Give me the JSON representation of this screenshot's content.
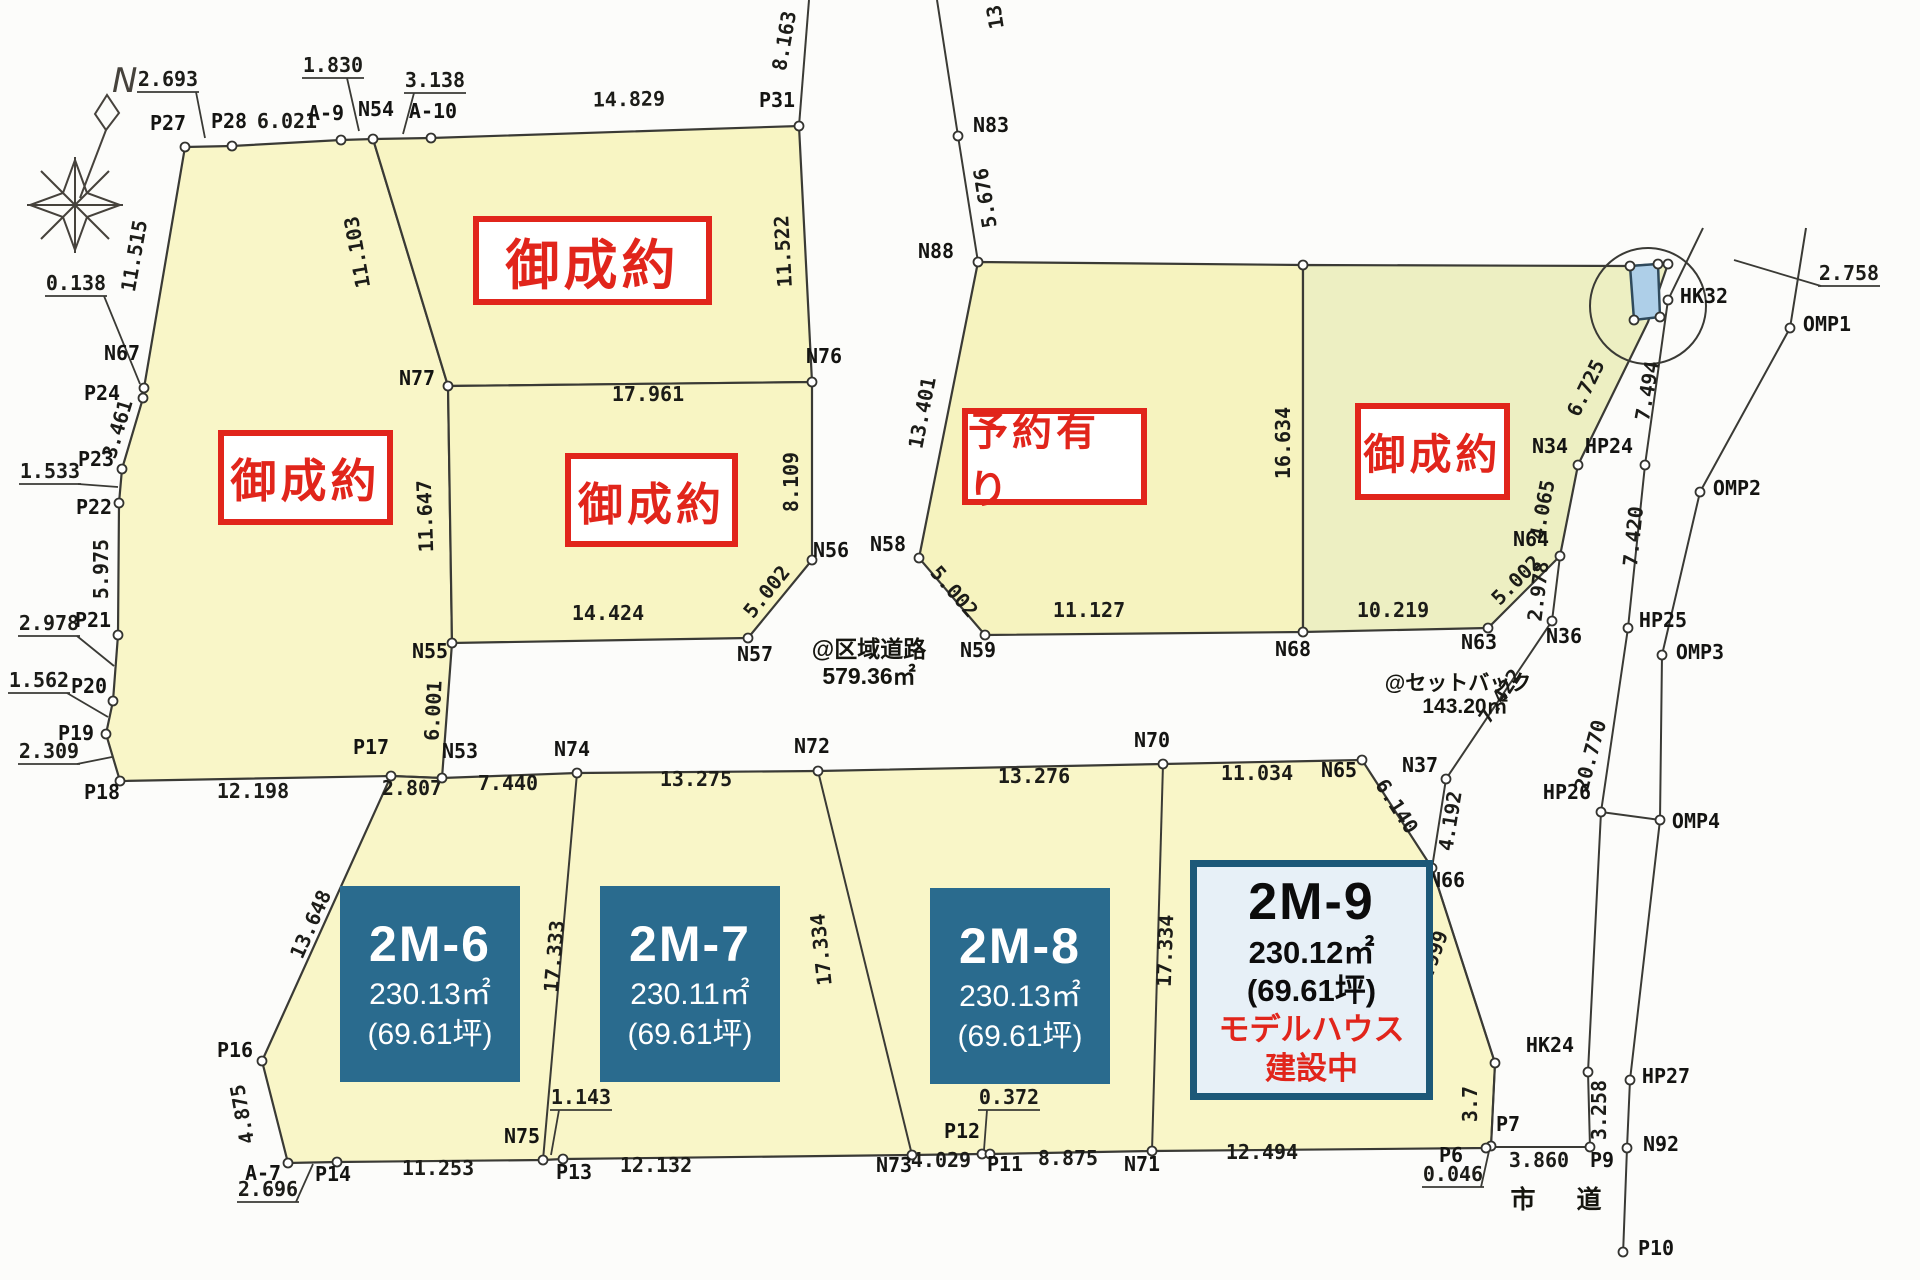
{
  "compass": {
    "label": "N"
  },
  "roads": {
    "district_road": {
      "line1": "@区域道路",
      "line2": "579.36㎡"
    },
    "setback": {
      "line1": "@セットバック",
      "line2": "143.20㎡"
    },
    "city_road": "市　道"
  },
  "colors": {
    "parcel_yellow": "#f9f6c8",
    "parcel_yellow2": "#f6f3bf",
    "parcel_green": "#edefc2",
    "water_blue": "#aecfe8",
    "lot_teal": "#2a6b8e",
    "lot_model_bg": "#e7f0f7",
    "lot_model_border": "#1c5878",
    "status_red": "#e1251b",
    "line": "#3a3a35"
  },
  "status_boxes": [
    {
      "text": "御成約",
      "x": 218,
      "y": 430,
      "w": 175,
      "h": 95,
      "fs": 46
    },
    {
      "text": "御成約",
      "x": 473,
      "y": 216,
      "w": 239,
      "h": 89,
      "fs": 54
    },
    {
      "text": "御成約",
      "x": 565,
      "y": 453,
      "w": 173,
      "h": 94,
      "fs": 45
    },
    {
      "text": "予約有り",
      "x": 962,
      "y": 408,
      "w": 185,
      "h": 97,
      "fs": 40
    },
    {
      "text": "御成約",
      "x": 1355,
      "y": 403,
      "w": 155,
      "h": 97,
      "fs": 42
    }
  ],
  "lots": [
    {
      "name": "2M-6",
      "area": "230.13㎡",
      "tsubo": "(69.61坪)",
      "style": "dark",
      "x": 340,
      "y": 886,
      "w": 180,
      "h": 196
    },
    {
      "name": "2M-7",
      "area": "230.11㎡",
      "tsubo": "(69.61坪)",
      "style": "dark",
      "x": 600,
      "y": 886,
      "w": 180,
      "h": 196
    },
    {
      "name": "2M-8",
      "area": "230.13㎡",
      "tsubo": "(69.61坪)",
      "style": "dark",
      "x": 930,
      "y": 888,
      "w": 180,
      "h": 196
    },
    {
      "name": "2M-9",
      "area": "230.12㎡",
      "tsubo": "(69.61坪)",
      "note1": "モデルハウス",
      "note2": "建設中",
      "style": "model",
      "x": 1190,
      "y": 860,
      "w": 243,
      "h": 240
    }
  ],
  "map": {
    "points": [
      {
        "n": "P27",
        "x": 185,
        "y": 147,
        "lx": 168,
        "ly": 130
      },
      {
        "n": "P28",
        "x": 232,
        "y": 146,
        "lx": 229,
        "ly": 128
      },
      {
        "n": "A-9",
        "x": 341,
        "y": 140,
        "lx": 326,
        "ly": 120
      },
      {
        "n": "N54",
        "x": 373,
        "y": 139,
        "lx": 376,
        "ly": 116
      },
      {
        "n": "A-10",
        "x": 431,
        "y": 138,
        "lx": 433,
        "ly": 118
      },
      {
        "n": "P31",
        "x": 799,
        "y": 126,
        "lx": 777,
        "ly": 107
      },
      {
        "n": "N67",
        "x": 144,
        "y": 388,
        "lx": 122,
        "ly": 360
      },
      {
        "n": "P24",
        "x": 143,
        "y": 398,
        "lx": 102,
        "ly": 400
      },
      {
        "n": "P23",
        "x": 122,
        "y": 469,
        "lx": 96,
        "ly": 466
      },
      {
        "n": "P22",
        "x": 119,
        "y": 503,
        "lx": 94,
        "ly": 514
      },
      {
        "n": "P21",
        "x": 118,
        "y": 635,
        "lx": 93,
        "ly": 627
      },
      {
        "n": "P20",
        "x": 113,
        "y": 701,
        "lx": 89,
        "ly": 693
      },
      {
        "n": "P19",
        "x": 106,
        "y": 734,
        "lx": 76,
        "ly": 740
      },
      {
        "n": "P18",
        "x": 120,
        "y": 781,
        "lx": 102,
        "ly": 799
      },
      {
        "n": "P17",
        "x": 391,
        "y": 776,
        "lx": 371,
        "ly": 754
      },
      {
        "n": "N53",
        "x": 442,
        "y": 778,
        "lx": 460,
        "ly": 758
      },
      {
        "n": "N55",
        "x": 452,
        "y": 643,
        "lx": 430,
        "ly": 658
      },
      {
        "n": "N77",
        "x": 448,
        "y": 386,
        "lx": 417,
        "ly": 385
      },
      {
        "n": "N76",
        "x": 812,
        "y": 382,
        "lx": 824,
        "ly": 363
      },
      {
        "n": "N56",
        "x": 812,
        "y": 560,
        "lx": 831,
        "ly": 557
      },
      {
        "n": "N57",
        "x": 748,
        "y": 638,
        "lx": 755,
        "ly": 661
      },
      {
        "n": "N83",
        "x": 958,
        "y": 136,
        "lx": 991,
        "ly": 132
      },
      {
        "n": "N88",
        "x": 978,
        "y": 262,
        "lx": 936,
        "ly": 258
      },
      {
        "n": "N58",
        "x": 919,
        "y": 558,
        "lx": 888,
        "ly": 551
      },
      {
        "n": "N59",
        "x": 985,
        "y": 635,
        "lx": 978,
        "ly": 657
      },
      {
        "n": "N68",
        "x": 1303,
        "y": 632,
        "lx": 1293,
        "ly": 656
      },
      {
        "n": "",
        "x": 1303,
        "y": 265
      },
      {
        "n": "N34",
        "x": 1578,
        "y": 465,
        "lx": 1550,
        "ly": 453
      },
      {
        "n": "N64",
        "x": 1560,
        "y": 556,
        "lx": 1531,
        "ly": 546
      },
      {
        "n": "N63",
        "x": 1488,
        "y": 628,
        "lx": 1479,
        "ly": 649
      },
      {
        "n": "N36",
        "x": 1552,
        "y": 621,
        "lx": 1564,
        "ly": 643
      },
      {
        "n": "N37",
        "x": 1446,
        "y": 779,
        "lx": 1420,
        "ly": 772
      },
      {
        "n": "N65",
        "x": 1362,
        "y": 760,
        "lx": 1339,
        "ly": 777
      },
      {
        "n": "N66",
        "x": 1432,
        "y": 868,
        "lx": 1447,
        "ly": 887
      },
      {
        "n": "",
        "x": 1495,
        "y": 1063
      },
      {
        "n": "P7",
        "x": 1491,
        "y": 1146,
        "lx": 1508,
        "ly": 1131
      },
      {
        "n": "P6",
        "x": 1486,
        "y": 1148,
        "lx": 1451,
        "ly": 1162
      },
      {
        "n": "P9",
        "x": 1590,
        "y": 1147,
        "lx": 1602,
        "ly": 1167
      },
      {
        "n": "N74",
        "x": 577,
        "y": 773,
        "lx": 572,
        "ly": 756
      },
      {
        "n": "N72",
        "x": 818,
        "y": 771,
        "lx": 812,
        "ly": 753
      },
      {
        "n": "N70",
        "x": 1163,
        "y": 764,
        "lx": 1152,
        "ly": 747
      },
      {
        "n": "N75",
        "x": 543,
        "y": 1160,
        "lx": 522,
        "ly": 1143
      },
      {
        "n": "P13",
        "x": 563,
        "y": 1159,
        "lx": 574,
        "ly": 1179
      },
      {
        "n": "N73",
        "x": 912,
        "y": 1155,
        "lx": 894,
        "ly": 1172
      },
      {
        "n": "P12",
        "x": 982,
        "y": 1154,
        "lx": 962,
        "ly": 1138
      },
      {
        "n": "P11",
        "x": 990,
        "y": 1154,
        "lx": 1005,
        "ly": 1171
      },
      {
        "n": "N71",
        "x": 1152,
        "y": 1151,
        "lx": 1142,
        "ly": 1171
      },
      {
        "n": "P14",
        "x": 337,
        "y": 1162,
        "lx": 333,
        "ly": 1181
      },
      {
        "n": "A-7",
        "x": 288,
        "y": 1163,
        "lx": 263,
        "ly": 1180
      },
      {
        "n": "P16",
        "x": 262,
        "y": 1061,
        "lx": 235,
        "ly": 1057
      },
      {
        "n": "HK32",
        "x": 1668,
        "y": 300,
        "lx": 1704,
        "ly": 303
      },
      {
        "n": "HP24",
        "x": 1645,
        "y": 465,
        "lx": 1609,
        "ly": 453
      },
      {
        "n": "HP25",
        "x": 1628,
        "y": 628,
        "lx": 1663,
        "ly": 627
      },
      {
        "n": "HP26",
        "x": 1601,
        "y": 812,
        "lx": 1567,
        "ly": 799
      },
      {
        "n": "HK24",
        "x": 1588,
        "y": 1072,
        "lx": 1550,
        "ly": 1052
      },
      {
        "n": "HP27",
        "x": 1630,
        "y": 1080,
        "lx": 1666,
        "ly": 1083
      },
      {
        "n": "N92",
        "x": 1627,
        "y": 1148,
        "lx": 1661,
        "ly": 1151
      },
      {
        "n": "P10",
        "x": 1623,
        "y": 1252,
        "lx": 1656,
        "ly": 1255
      },
      {
        "n": "OMP1",
        "x": 1790,
        "y": 328,
        "lx": 1827,
        "ly": 331
      },
      {
        "n": "OMP2",
        "x": 1700,
        "y": 492,
        "lx": 1737,
        "ly": 495
      },
      {
        "n": "OMP3",
        "x": 1662,
        "y": 655,
        "lx": 1700,
        "ly": 659
      },
      {
        "n": "OMP4",
        "x": 1660,
        "y": 820,
        "lx": 1696,
        "ly": 828
      },
      {
        "n": "",
        "x": 1630,
        "y": 266
      },
      {
        "n": "",
        "x": 1658,
        "y": 264
      },
      {
        "n": "",
        "x": 1634,
        "y": 320
      },
      {
        "n": "",
        "x": 1660,
        "y": 317
      },
      {
        "n": "",
        "x": 1668,
        "y": 264
      }
    ],
    "dimensions": [
      {
        "t": "6.021",
        "x": 287,
        "y": 128,
        "r": 0
      },
      {
        "t": "14.829",
        "x": 629,
        "y": 106,
        "r": -1
      },
      {
        "t": "8.163",
        "x": 791,
        "y": 42,
        "r": -80
      },
      {
        "t": "11.515",
        "x": 141,
        "y": 257,
        "r": -80
      },
      {
        "t": "3.461",
        "x": 124,
        "y": 431,
        "r": -73
      },
      {
        "t": "5.975",
        "x": 108,
        "y": 569,
        "r": -90
      },
      {
        "t": "11.103",
        "x": 364,
        "y": 251,
        "r": -100
      },
      {
        "t": "11.647",
        "x": 432,
        "y": 516,
        "r": -92
      },
      {
        "t": "6.001",
        "x": 440,
        "y": 711,
        "r": -87
      },
      {
        "t": "17.961",
        "x": 648,
        "y": 401,
        "r": 0
      },
      {
        "t": "11.522",
        "x": 790,
        "y": 251,
        "r": -93
      },
      {
        "t": "8.109",
        "x": 798,
        "y": 482,
        "r": -90
      },
      {
        "t": "5.002",
        "x": 772,
        "y": 596,
        "r": -51
      },
      {
        "t": "14.424",
        "x": 608,
        "y": 620,
        "r": 0
      },
      {
        "t": "12.198",
        "x": 253,
        "y": 798,
        "r": 0
      },
      {
        "t": "2.807",
        "x": 412,
        "y": 795,
        "r": 0
      },
      {
        "t": "5.676",
        "x": 992,
        "y": 197,
        "r": -99
      },
      {
        "t": "13",
        "x": 1002,
        "y": 16,
        "r": -99
      },
      {
        "t": "13.401",
        "x": 929,
        "y": 414,
        "r": -79
      },
      {
        "t": "16.634",
        "x": 1290,
        "y": 443,
        "r": -90
      },
      {
        "t": "5.002",
        "x": 949,
        "y": 596,
        "r": 49
      },
      {
        "t": "11.127",
        "x": 1089,
        "y": 617,
        "r": 0
      },
      {
        "t": "10.219",
        "x": 1393,
        "y": 617,
        "r": 0
      },
      {
        "t": "6.725",
        "x": 1592,
        "y": 391,
        "r": -64
      },
      {
        "t": "4.065",
        "x": 1549,
        "y": 511,
        "r": -79
      },
      {
        "t": "5.002",
        "x": 1521,
        "y": 585,
        "r": -45
      },
      {
        "t": "2.978",
        "x": 1545,
        "y": 592,
        "r": -83
      },
      {
        "t": "7.494",
        "x": 1654,
        "y": 392,
        "r": -80
      },
      {
        "t": "7.420",
        "x": 1640,
        "y": 537,
        "r": -84
      },
      {
        "t": "7.422",
        "x": 1506,
        "y": 700,
        "r": -56
      },
      {
        "t": "20.770",
        "x": 1597,
        "y": 757,
        "r": -75
      },
      {
        "t": "4.192",
        "x": 1457,
        "y": 822,
        "r": -81
      },
      {
        "t": "6.140",
        "x": 1391,
        "y": 810,
        "r": 57
      },
      {
        "t": "8.999",
        "x": 1438,
        "y": 962,
        "r": -70
      },
      {
        "t": "3.258",
        "x": 1606,
        "y": 1110,
        "r": -90
      },
      {
        "t": "3.7",
        "x": 1477,
        "y": 1104,
        "r": -90
      },
      {
        "t": "17.333",
        "x": 561,
        "y": 957,
        "r": -85
      },
      {
        "t": "17.334",
        "x": 828,
        "y": 949,
        "r": -96
      },
      {
        "t": "17.334",
        "x": 1172,
        "y": 951,
        "r": -88
      },
      {
        "t": "13.648",
        "x": 317,
        "y": 927,
        "r": -66
      },
      {
        "t": "4.875",
        "x": 249,
        "y": 1113,
        "r": -100
      },
      {
        "t": "7.440",
        "x": 508,
        "y": 790,
        "r": 0
      },
      {
        "t": "13.275",
        "x": 696,
        "y": 786,
        "r": 0
      },
      {
        "t": "13.276",
        "x": 1034,
        "y": 783,
        "r": 0
      },
      {
        "t": "11.034",
        "x": 1257,
        "y": 780,
        "r": 0
      },
      {
        "t": "11.253",
        "x": 438,
        "y": 1175,
        "r": 0
      },
      {
        "t": "12.132",
        "x": 656,
        "y": 1172,
        "r": 0
      },
      {
        "t": "4.029",
        "x": 941,
        "y": 1167,
        "r": 0
      },
      {
        "t": "8.875",
        "x": 1068,
        "y": 1165,
        "r": 0
      },
      {
        "t": "12.494",
        "x": 1262,
        "y": 1159,
        "r": 0
      },
      {
        "t": "3.860",
        "x": 1539,
        "y": 1167,
        "r": 0
      }
    ],
    "leaders": [
      {
        "t": "2.693",
        "x": 168,
        "y": 86,
        "pts": [
          [
            196,
            92
          ],
          [
            205,
            138
          ]
        ]
      },
      {
        "t": "1.830",
        "x": 333,
        "y": 72,
        "pts": [
          [
            347,
            78
          ],
          [
            359,
            131
          ]
        ]
      },
      {
        "t": "3.138",
        "x": 435,
        "y": 87,
        "pts": [
          [
            414,
            93
          ],
          [
            403,
            134
          ]
        ]
      },
      {
        "t": "0.138",
        "x": 76,
        "y": 290,
        "pts": [
          [
            104,
            296
          ],
          [
            140,
            384
          ]
        ]
      },
      {
        "t": "1.533",
        "x": 50,
        "y": 478,
        "pts": [
          [
            78,
            484
          ],
          [
            118,
            487
          ]
        ]
      },
      {
        "t": "2.978",
        "x": 49,
        "y": 630,
        "pts": [
          [
            77,
            636
          ],
          [
            114,
            666
          ]
        ]
      },
      {
        "t": "1.562",
        "x": 39,
        "y": 687,
        "pts": [
          [
            67,
            693
          ],
          [
            108,
            717
          ]
        ]
      },
      {
        "t": "2.309",
        "x": 49,
        "y": 758,
        "pts": [
          [
            77,
            764
          ],
          [
            112,
            757
          ]
        ]
      },
      {
        "t": "1.143",
        "x": 581,
        "y": 1104,
        "pts": [
          [
            559,
            1110
          ],
          [
            551,
            1155
          ]
        ]
      },
      {
        "t": "0.372",
        "x": 1009,
        "y": 1104,
        "pts": [
          [
            987,
            1110
          ],
          [
            984,
            1150
          ]
        ]
      },
      {
        "t": "2.696",
        "x": 268,
        "y": 1196,
        "pts": [
          [
            296,
            1202
          ],
          [
            313,
            1164
          ]
        ]
      },
      {
        "t": "0.046",
        "x": 1453,
        "y": 1181,
        "pts": [
          [
            1481,
            1187
          ],
          [
            1489,
            1151
          ]
        ]
      },
      {
        "t": "2.758",
        "x": 1849,
        "y": 280,
        "pts": [
          [
            1821,
            286
          ],
          [
            1734,
            260
          ]
        ]
      }
    ]
  }
}
